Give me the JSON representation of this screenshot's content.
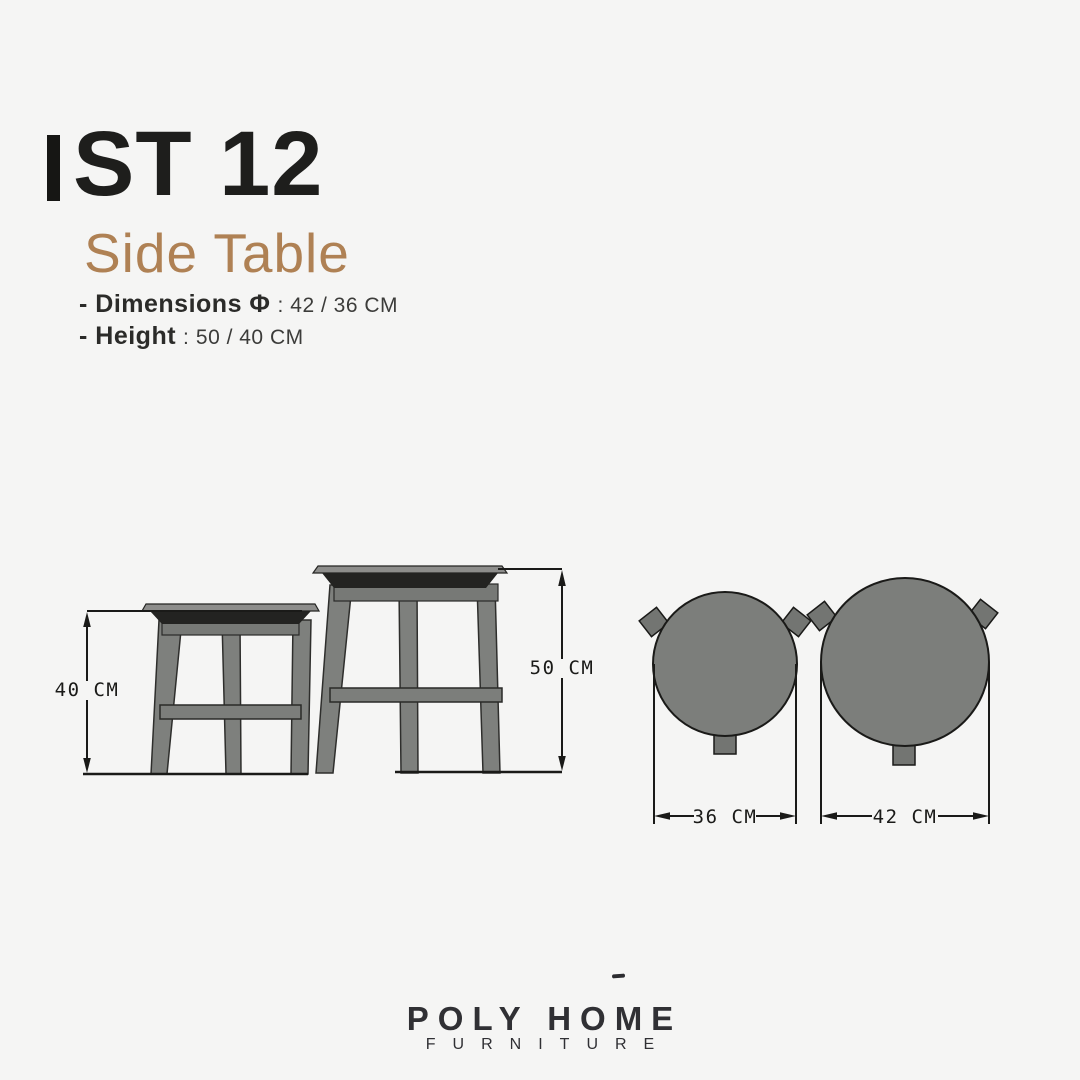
{
  "header": {
    "product_code": "ST 12",
    "product_name": "Side Table"
  },
  "specs": [
    {
      "label": "- Dimensions Φ",
      "separator": ":",
      "value": "42 / 36 CM"
    },
    {
      "label": "- Height",
      "separator": ":",
      "value": "50 / 40 CM"
    }
  ],
  "drawing": {
    "front_view": {
      "small_table_height_label": "40 CM",
      "large_table_height_label": "50 CM"
    },
    "top_view": {
      "small_table_diameter_label": "36 CM",
      "large_table_diameter_label": "42 CM"
    }
  },
  "footer": {
    "brand_name": "POLY HOME",
    "brand_subtitle": "FURNITURE"
  },
  "colors": {
    "background": "#f5f5f4",
    "text_primary": "#1e1e1c",
    "accent_brown": "#af8154",
    "drawing_gray": "#7c7e7b",
    "outline_dark": "#1a1a18",
    "brand_dark": "#303034"
  }
}
